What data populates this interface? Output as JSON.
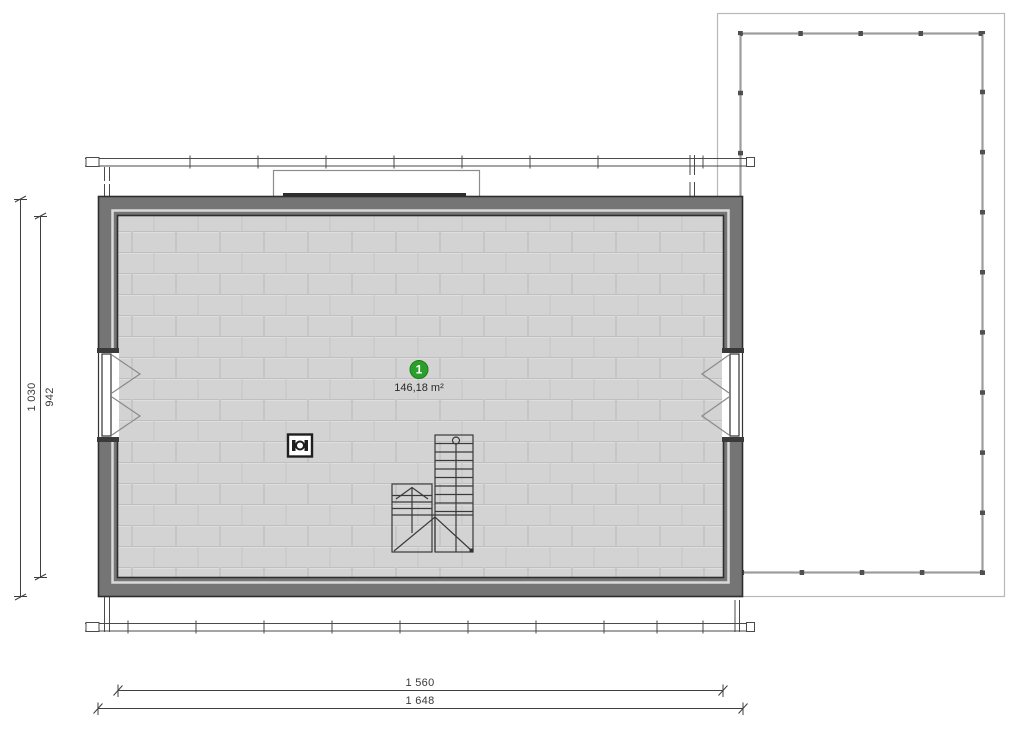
{
  "plan_type": "floor-plan",
  "room": {
    "number": "1",
    "area": "146,18 m²"
  },
  "dims": {
    "left_outer": "1 030",
    "left_inner": "942",
    "bottom_inner": "1 560",
    "bottom_outer": "1 648"
  },
  "symbols": {
    "staircase": "l-shaped-stair-with-walking-line",
    "chimney": "chimney-flue",
    "window_left": "double-casement-window",
    "window_right": "double-casement-window",
    "terrace": "terrace-with-railing-posts",
    "dormer": "roof-dormer-outline",
    "eaves": "eaves-line-with-ticks"
  },
  "colors": {
    "wall_fill": "#757575",
    "wall_line": "#2e2e2e",
    "floor_fill": "#d3d3d3",
    "floor_joint": "#bfbfbf",
    "badge_green": "#2aa02a",
    "terrace_railing": "#9c9c9c",
    "terrace_outer": "#b8b8b8",
    "dimension_line": "#3f3f3f"
  }
}
